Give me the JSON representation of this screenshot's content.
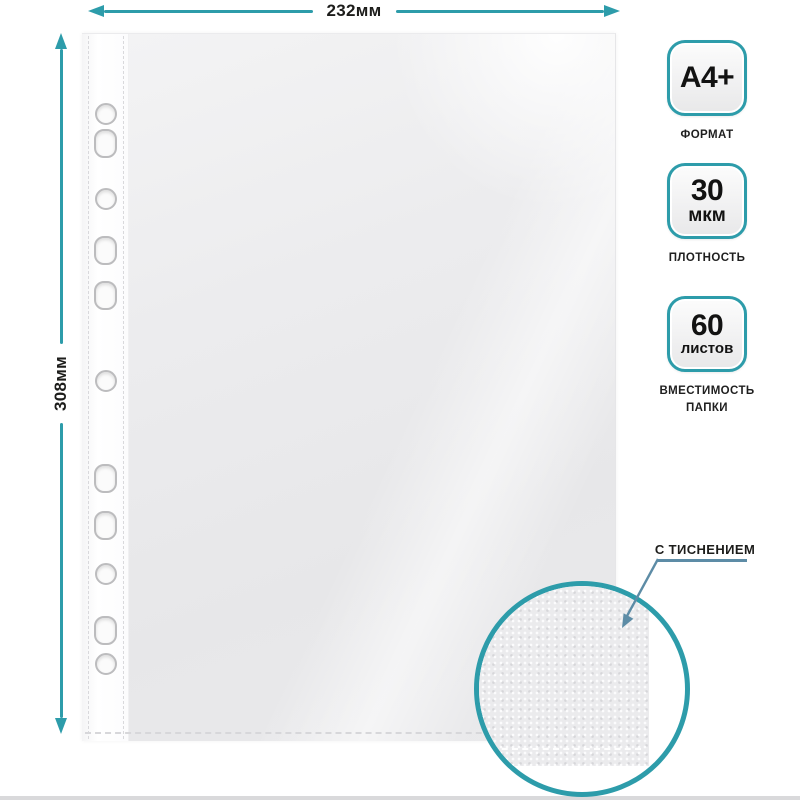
{
  "dimensions": {
    "width": "232мм",
    "height": "308мм"
  },
  "badges": [
    {
      "lines": [
        "A4+"
      ],
      "label_lines": [
        "ФОРМАТ"
      ]
    },
    {
      "lines": [
        "30",
        "мкм"
      ],
      "label_lines": [
        "ПЛОТНОСТЬ"
      ]
    },
    {
      "lines": [
        "60",
        "листов"
      ],
      "label_lines": [
        "ВМЕСТИМОСТЬ",
        "ПАПКИ"
      ]
    }
  ],
  "callout": {
    "label": "С ТИСНЕНИЕМ"
  },
  "colors": {
    "accent": "#2d9caa",
    "callout_arrow": "#5d8ca6",
    "text": "#1d1d1b"
  }
}
